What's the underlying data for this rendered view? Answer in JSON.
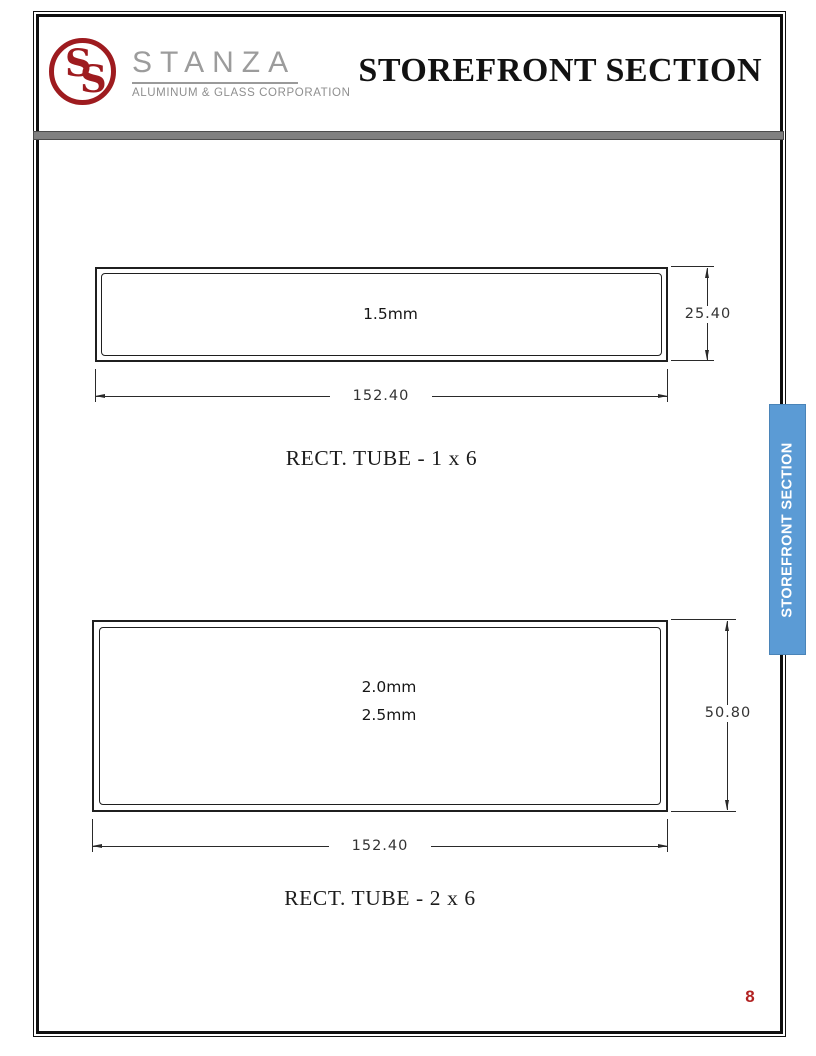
{
  "header": {
    "logo": {
      "monogram": "SS",
      "monogram_first": "S",
      "monogram_second": "S",
      "name": "STANZA",
      "subtitle": "ALUMINUM & GLASS CORPORATION",
      "accent_color": "#9E1B1F",
      "gray_color": "#9C9C9C"
    },
    "title": "STOREFRONT SECTION",
    "divider_color": "#808080"
  },
  "figures": [
    {
      "caption": "RECT. TUBE - 1 x 6",
      "thickness_labels": [
        "1.5mm"
      ],
      "height_dim": "25.40",
      "width_dim": "152.40"
    },
    {
      "caption": "RECT. TUBE - 2 x 6",
      "thickness_labels": [
        "2.0mm",
        "2.5mm"
      ],
      "height_dim": "50.80",
      "width_dim": "152.40"
    }
  ],
  "side_tab": {
    "label": "STOREFRONT SECTION",
    "bg_color": "#5B9BD5",
    "text_color": "#FFFFFF"
  },
  "page": {
    "number": "8",
    "number_color": "#B22222"
  }
}
